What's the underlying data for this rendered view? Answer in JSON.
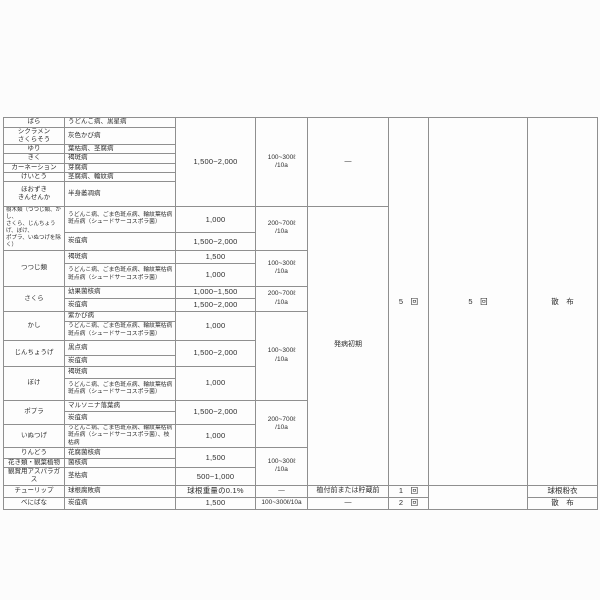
{
  "colors": {
    "page_bg": "#fcfcfc",
    "table_bg": "#fdfdfd",
    "grid_line": "#8f8f8f",
    "text": "#2e2e2e"
  },
  "table": {
    "rows": [
      {
        "h": 10,
        "cells": [
          {
            "c": 0,
            "t": "ばら"
          },
          {
            "c": 1,
            "t": "うどんこ病、黒星病"
          },
          {
            "c": 2,
            "t": "1,500~2,000",
            "rs": 7
          },
          {
            "c": 3,
            "t": "100~300ℓ\n/10a",
            "rs": 7
          },
          {
            "c": 4,
            "t": "—",
            "rs": 7
          },
          {
            "c": 5,
            "t": "5　回",
            "rs": 25
          },
          {
            "c": 6,
            "t": "5　回",
            "rs": 25
          },
          {
            "c": 7,
            "t": "散　布",
            "rs": 25
          }
        ]
      },
      {
        "h": 14,
        "cells": [
          {
            "c": 0,
            "t": "シクラメン\nさくらそう"
          },
          {
            "c": 1,
            "t": "灰色かび病"
          }
        ]
      },
      {
        "h": 9,
        "cells": [
          {
            "c": 0,
            "t": "ゆり"
          },
          {
            "c": 1,
            "t": "葉枯病、茎腐病"
          }
        ]
      },
      {
        "h": 9,
        "cells": [
          {
            "c": 0,
            "t": "きく"
          },
          {
            "c": 1,
            "t": "褐斑病"
          }
        ]
      },
      {
        "h": 9,
        "cells": [
          {
            "c": 0,
            "t": "カーネーション"
          },
          {
            "c": 1,
            "t": "芽腐病"
          }
        ]
      },
      {
        "h": 9,
        "cells": [
          {
            "c": 0,
            "t": "けいとう"
          },
          {
            "c": 1,
            "t": "茎腐病、輪紋病"
          }
        ]
      },
      {
        "h": 25,
        "cells": [
          {
            "c": 0,
            "t": "ほおずき\nきんせんか"
          },
          {
            "c": 1,
            "t": "半身萎凋病"
          }
        ]
      },
      {
        "h": 21,
        "cells": [
          {
            "c": 0,
            "t": "樹木類（つつじ類、かし、\nさくら、じんちょうげ、ぼけ、\nポプラ、いぬつげを除く）",
            "rs": 2,
            "cls": "xs"
          },
          {
            "c": 1,
            "t": "うどんこ病、ごま色斑点病、輪紋葉枯病\n斑点病（シュードサーコスポラ菌）",
            "cls": "sm"
          },
          {
            "c": 2,
            "t": "1,000"
          },
          {
            "c": 3,
            "t": "200~700ℓ\n/10a",
            "rs": 2
          },
          {
            "c": 4,
            "t": "発病初期",
            "rs": 18
          }
        ]
      },
      {
        "h": 14,
        "cells": [
          {
            "c": 1,
            "t": "炭疽病"
          },
          {
            "c": 2,
            "t": "1,500~2,000"
          }
        ]
      },
      {
        "h": 13,
        "cells": [
          {
            "c": 0,
            "t": "つつじ類",
            "rs": 2
          },
          {
            "c": 1,
            "t": "褐斑病"
          },
          {
            "c": 2,
            "t": "1,500"
          },
          {
            "c": 3,
            "t": "100~300ℓ\n/10a",
            "rs": 2
          }
        ]
      },
      {
        "h": 23,
        "cells": [
          {
            "c": 1,
            "t": "うどんこ病、ごま色斑点病、輪紋葉枯病\n斑点病（シュードサーコスポラ菌）",
            "cls": "sm"
          },
          {
            "c": 2,
            "t": "1,000"
          }
        ]
      },
      {
        "h": 12,
        "cells": [
          {
            "c": 0,
            "t": "さくら",
            "rs": 2
          },
          {
            "c": 1,
            "t": "幼果菌核病"
          },
          {
            "c": 2,
            "t": "1,000~1,500"
          },
          {
            "c": 3,
            "t": "200~700ℓ\n/10a",
            "rs": 2
          }
        ]
      },
      {
        "h": 13,
        "cells": [
          {
            "c": 1,
            "t": "炭疽病"
          },
          {
            "c": 2,
            "t": "1,500~2,000"
          }
        ]
      },
      {
        "h": 10,
        "cells": [
          {
            "c": 0,
            "t": "かし",
            "rs": 2
          },
          {
            "c": 1,
            "t": "紫かび病"
          },
          {
            "c": 2,
            "t": "1,000",
            "rs": 2
          },
          {
            "c": 3,
            "t": "100~300ℓ\n/10a",
            "rs": 6
          }
        ]
      },
      {
        "h": 19,
        "cells": [
          {
            "c": 1,
            "t": "うどんこ病、ごま色斑点病、輪紋葉枯病\n斑点病（シュードサーコスポラ菌）",
            "cls": "sm"
          }
        ]
      },
      {
        "h": 15,
        "cells": [
          {
            "c": 0,
            "t": "じんちょうげ",
            "rs": 2
          },
          {
            "c": 1,
            "t": "黒点病"
          },
          {
            "c": 2,
            "t": "1,500~2,000",
            "rs": 2
          }
        ]
      },
      {
        "h": 11,
        "cells": [
          {
            "c": 1,
            "t": "炭疽病"
          }
        ]
      },
      {
        "h": 12,
        "cells": [
          {
            "c": 0,
            "t": "ぼけ",
            "rs": 2
          },
          {
            "c": 1,
            "t": "褐斑病"
          },
          {
            "c": 2,
            "t": "1,000",
            "rs": 2
          }
        ]
      },
      {
        "h": 22,
        "cells": [
          {
            "c": 1,
            "t": "うどんこ病、ごま色斑点病、輪紋葉枯病\n斑点病（シュードサーコスポラ菌）",
            "cls": "sm"
          }
        ]
      },
      {
        "h": 11,
        "cells": [
          {
            "c": 0,
            "t": "ポプラ",
            "rs": 2
          },
          {
            "c": 1,
            "t": "マルソニナ落葉病"
          },
          {
            "c": 2,
            "t": "1,500~2,000",
            "rs": 2
          },
          {
            "c": 3,
            "t": "200~700ℓ\n/10a",
            "rs": 3
          }
        ]
      },
      {
        "h": 13,
        "cells": [
          {
            "c": 1,
            "t": "炭疽病"
          }
        ]
      },
      {
        "h": 18,
        "cells": [
          {
            "c": 0,
            "t": "いぬつげ"
          },
          {
            "c": 1,
            "t": "うどんこ病、ごま色斑点病、輪紋葉枯病\n斑点病（シュードサーコスポラ菌）、枝枯病",
            "cls": "sm"
          },
          {
            "c": 2,
            "t": "1,000"
          }
        ]
      },
      {
        "h": 11,
        "cells": [
          {
            "c": 0,
            "t": "りんどう"
          },
          {
            "c": 1,
            "t": "花腐菌核病"
          },
          {
            "c": 2,
            "t": "1,500",
            "rs": 2
          },
          {
            "c": 3,
            "t": "100~300ℓ\n/10a",
            "rs": 3
          }
        ]
      },
      {
        "h": 9,
        "cells": [
          {
            "c": 0,
            "t": "花き類・観葉植物"
          },
          {
            "c": 1,
            "t": "菌核病"
          }
        ]
      },
      {
        "h": 9,
        "cells": [
          {
            "c": 0,
            "t": "観賞用アスパラガス"
          },
          {
            "c": 1,
            "t": "茎枯病"
          },
          {
            "c": 2,
            "t": "500~1,000"
          }
        ]
      },
      {
        "h": 12,
        "cells": [
          {
            "c": 0,
            "t": "チューリップ"
          },
          {
            "c": 1,
            "t": "球根腐敗病"
          },
          {
            "c": 2,
            "t": "球根重量の0.1%"
          },
          {
            "c": 3,
            "t": "—"
          },
          {
            "c": 4,
            "t": "植付前または貯蔵前"
          },
          {
            "c": 5,
            "t": "1　回"
          },
          {
            "c": 6,
            "t": "",
            "rs": 2
          },
          {
            "c": 7,
            "t": "球根粉衣"
          }
        ]
      },
      {
        "h": 12,
        "cells": [
          {
            "c": 0,
            "t": "べにばな"
          },
          {
            "c": 1,
            "t": "炭疽病"
          },
          {
            "c": 2,
            "t": "1,500"
          },
          {
            "c": 3,
            "t": "100~300ℓ/10a"
          },
          {
            "c": 4,
            "t": "—"
          },
          {
            "c": 5,
            "t": "2　回"
          },
          {
            "c": 7,
            "t": "散　布"
          }
        ]
      }
    ]
  }
}
